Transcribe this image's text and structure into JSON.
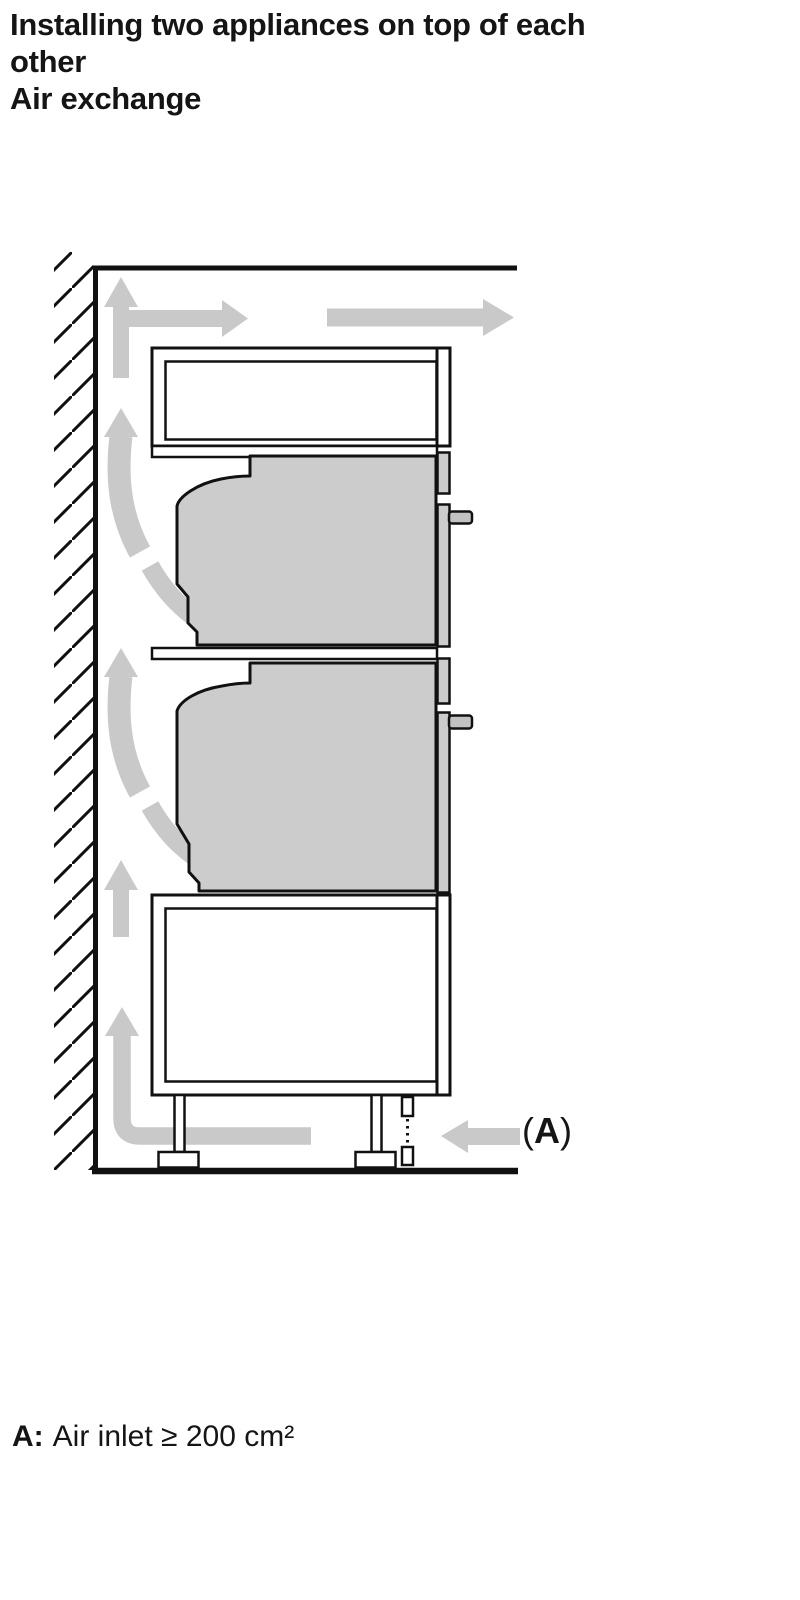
{
  "title": {
    "lines": [
      "Installing two appliances on top of each",
      "other",
      "Air exchange"
    ]
  },
  "diagram": {
    "label_a": {
      "open": "(",
      "letter": "A",
      "close": ")"
    },
    "colors": {
      "outline": "#111111",
      "appliance_fill": "#cccccc",
      "airflow_arrow": "#c9c9c9",
      "background": "#ffffff"
    },
    "elements": [
      "wall-hatching",
      "ceiling-line",
      "floor-line",
      "upper-cabinet-compartment",
      "upper-oven",
      "middle-shelf",
      "lower-oven",
      "base-cabinet-compartment",
      "cabinet-feet",
      "plinth-air-gap",
      "airflow-arrows",
      "air-inlet-arrow"
    ]
  },
  "note": {
    "label": "A:",
    "text": "Air inlet ≥ 200 cm²"
  }
}
